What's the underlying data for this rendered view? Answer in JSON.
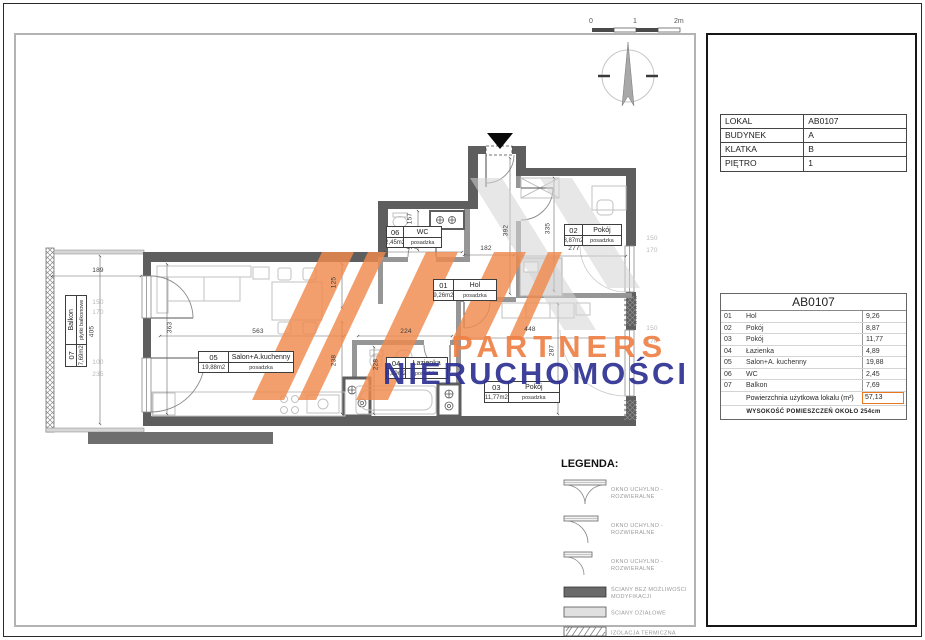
{
  "scale_bar": {
    "labels": [
      "0",
      "1",
      "2m"
    ]
  },
  "watermark": {
    "line1": "PARTNERS",
    "line2": "NIERUCHOMOŚCI",
    "orange": "#ee8147",
    "navy": "#2e3192"
  },
  "plan": {
    "room_tags": [
      {
        "id": "06",
        "name": "WC",
        "area": "2,45m2",
        "floor": "posadzka"
      },
      {
        "id": "01",
        "name": "Hol",
        "area": "9,26m2",
        "floor": "posadzka"
      },
      {
        "id": "02",
        "name": "Pokój",
        "area": "8,87m2",
        "floor": "posadzka"
      },
      {
        "id": "05",
        "name": "Salon+A.kuchenny",
        "area": "19,88m2",
        "floor": "posadzka"
      },
      {
        "id": "04",
        "name": "Łazienka",
        "area": "4,89m2",
        "floor": "posadzka"
      },
      {
        "id": "03",
        "name": "Pokój",
        "area": "11,77m2",
        "floor": "posadzka"
      },
      {
        "id": "07",
        "name": "Balkon",
        "area": "7,69m2",
        "floor": "płytki balkonowe"
      }
    ],
    "dims": [
      {
        "t": "189"
      },
      {
        "t": "150"
      },
      {
        "t": "170"
      },
      {
        "t": "405"
      },
      {
        "t": "100"
      },
      {
        "t": "235"
      },
      {
        "t": "363"
      },
      {
        "t": "563"
      },
      {
        "t": "125"
      },
      {
        "t": "238"
      },
      {
        "t": "224"
      },
      {
        "t": "228"
      },
      {
        "t": "170"
      },
      {
        "t": "157"
      },
      {
        "t": "182"
      },
      {
        "t": "392"
      },
      {
        "t": "277"
      },
      {
        "t": "335"
      },
      {
        "t": "448"
      },
      {
        "t": "287"
      },
      {
        "t": "150"
      },
      {
        "t": "170"
      },
      {
        "t": "150"
      },
      {
        "t": "170"
      }
    ]
  },
  "legend": {
    "title": "LEGENDA:",
    "windows": [
      "OKNO UCHYLNO - ROZWIERALNE",
      "OKNO UCHYLNO - ROZWIERALNE",
      "OKNO UCHYLNO - ROZWIERALNE"
    ],
    "walls": [
      {
        "label": "ŚCIANY BEZ MOŻLIWOŚCI MODYFIKACJI"
      },
      {
        "label": "ŚCIANY DZIAŁOWE"
      },
      {
        "label": "IZOLACJA TERMICZNA"
      }
    ]
  },
  "panel": {
    "info_rows": [
      [
        "LOKAL",
        "AB0107"
      ],
      [
        "BUDYNEK",
        "A"
      ],
      [
        "KLATKA",
        "B"
      ],
      [
        "PIĘTRO",
        "1"
      ]
    ],
    "unit_table": {
      "title": "AB0107",
      "rows": [
        [
          "01",
          "Hol",
          "9,26"
        ],
        [
          "02",
          "Pokój",
          "8,87"
        ],
        [
          "03",
          "Pokój",
          "11,77"
        ],
        [
          "04",
          "Łazienka",
          "4,89"
        ],
        [
          "05",
          "Salon+A. kuchenny",
          "19,88"
        ],
        [
          "06",
          "WC",
          "2,45"
        ],
        [
          "07",
          "Balkon",
          "7,69"
        ]
      ],
      "total_label": "Powierzchnia użytkowa lokalu (m²)",
      "total_value": "57,13",
      "footer": "WYSOKOŚĆ POMIESZCZEŃ OKOŁO 254cm"
    }
  }
}
